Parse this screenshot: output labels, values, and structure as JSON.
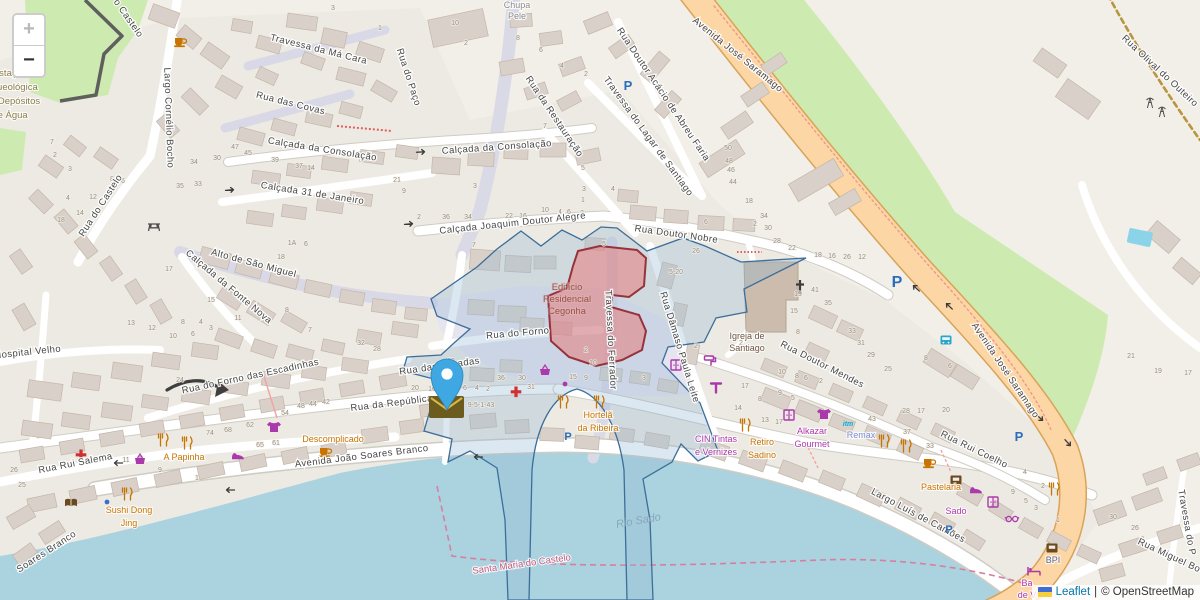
{
  "controls": {
    "zoom_in_label": "+",
    "zoom_out_label": "−"
  },
  "attribution": {
    "leaflet_link": "Leaflet",
    "separator": "|",
    "osm_text": "© OpenStreetMap"
  },
  "colors": {
    "land": "#f2efe8",
    "water": "#aad3df",
    "green": "#cdebb0",
    "road_primary": "#fcd6a4",
    "building": "#d9d0c9",
    "selection_stroke": "#3c6e99",
    "selection_fill": "rgba(147,183,211,0.32)",
    "highlight_fill": "rgba(231,123,123,0.55)",
    "highlight_stroke": "#97323a",
    "marker": "#3fa7e1"
  },
  "street_labels": [
    {
      "t": "Travessa da Má Cara",
      "x": 318,
      "y": 52,
      "r": 14
    },
    {
      "t": "Rua do Paço",
      "x": 406,
      "y": 78,
      "r": 72
    },
    {
      "t": "Rua das Covas",
      "x": 290,
      "y": 106,
      "r": 14
    },
    {
      "t": "Calçada da Consolação",
      "x": 322,
      "y": 152,
      "r": 9
    },
    {
      "t": "Calçada da Consolação",
      "x": 497,
      "y": 150,
      "r": -4
    },
    {
      "t": "Calçada 31 de Janeiro",
      "x": 312,
      "y": 196,
      "r": 9
    },
    {
      "t": "o Castelo",
      "x": 126,
      "y": 20,
      "r": 55
    },
    {
      "t": "Rua do Castelo",
      "x": 103,
      "y": 207,
      "r": -57
    },
    {
      "t": "Largo Cornélio Bocho",
      "x": 166,
      "y": 118,
      "r": 88
    },
    {
      "t": "Alto de São Miguel",
      "x": 253,
      "y": 266,
      "r": 15
    },
    {
      "t": "Calçada da Fonte Nova",
      "x": 227,
      "y": 289,
      "r": 40
    },
    {
      "t": "Calçada Joaquim Doutor Alegre",
      "x": 513,
      "y": 226,
      "r": -6
    },
    {
      "t": "Rua da Restauração",
      "x": 552,
      "y": 118,
      "r": 56
    },
    {
      "t": "Rua Doutor Nobre",
      "x": 676,
      "y": 237,
      "r": 8
    },
    {
      "t": "Travessa do Ferrador",
      "x": 608,
      "y": 340,
      "r": 87
    },
    {
      "t": "Rua Dâmaso Paula Leite",
      "x": 677,
      "y": 348,
      "r": 73
    },
    {
      "t": "Rua do Forno",
      "x": 518,
      "y": 336,
      "r": -5
    },
    {
      "t": "Rua do Forno das Escadinhas",
      "x": 251,
      "y": 379,
      "r": -12
    },
    {
      "t": "Hospital Velho",
      "x": 28,
      "y": 355,
      "r": -6
    },
    {
      "t": "Rua Rui Salema",
      "x": 76,
      "y": 466,
      "r": -11
    },
    {
      "t": "Rua da República",
      "x": 392,
      "y": 406,
      "r": -7
    },
    {
      "t": "Rua das Escadas",
      "x": 440,
      "y": 369,
      "r": -8
    },
    {
      "t": "Avenida João Soares Branco",
      "x": 362,
      "y": 459,
      "r": -7
    },
    {
      "t": "Soares Branco",
      "x": 48,
      "y": 554,
      "r": -33
    },
    {
      "t": "Travessa do Lagar de Santiago",
      "x": 646,
      "y": 138,
      "r": 54
    },
    {
      "t": "Rua Doutor Acácio de Abreu Faria",
      "x": 661,
      "y": 96,
      "r": 56
    },
    {
      "t": "Avenida José Saramago",
      "x": 736,
      "y": 57,
      "r": 39
    },
    {
      "t": "Avenida José Saramago",
      "x": 1003,
      "y": 372,
      "r": 56
    },
    {
      "t": "Rua Olival do Outeiro",
      "x": 1158,
      "y": 73,
      "r": 43
    },
    {
      "t": "Rua Doutor Mendes",
      "x": 821,
      "y": 367,
      "r": 27
    },
    {
      "t": "Rua Rui Coelho",
      "x": 973,
      "y": 452,
      "r": 26
    },
    {
      "t": "Largo Luís de Camões",
      "x": 917,
      "y": 518,
      "r": 28
    },
    {
      "t": "Rua Miguel Bo",
      "x": 1168,
      "y": 558,
      "r": 25
    },
    {
      "t": "Travessa do P",
      "x": 1184,
      "y": 523,
      "r": 80
    }
  ],
  "place_labels": [
    {
      "lines": [
        "Estação",
        "Arqueológica",
        "dos Depósitos",
        "de Água"
      ],
      "x": 10,
      "y": 76,
      "lh": 14,
      "c": "c-site"
    },
    {
      "lines": [
        "Chupa",
        "Pele"
      ],
      "x": 517,
      "y": 8,
      "lh": 11,
      "c": "c-build"
    },
    {
      "lines": [
        "Igreja de",
        "Santiago"
      ],
      "x": 747,
      "y": 339,
      "lh": 12,
      "c": "c-church"
    },
    {
      "lines": [
        "Edifício",
        "Residencial",
        "Cegonha"
      ],
      "x": 567,
      "y": 290,
      "lh": 12,
      "c": "c-redbuild"
    },
    {
      "lines": [
        "Hortelã",
        "da Ribeira"
      ],
      "x": 598,
      "y": 418,
      "lh": 13,
      "c": "c-food"
    },
    {
      "lines": [
        "Sushi Dong",
        "Jing"
      ],
      "x": 129,
      "y": 513,
      "lh": 13,
      "c": "c-food"
    },
    {
      "lines": [
        "CIN Tintas",
        "e Vernizes"
      ],
      "x": 716,
      "y": 442,
      "lh": 13,
      "c": "c-shop"
    },
    {
      "lines": [
        "Retiro",
        "Sadino"
      ],
      "x": 762,
      "y": 445,
      "lh": 13,
      "c": "c-food"
    },
    {
      "lines": [
        "Alkazar",
        "Gourmet"
      ],
      "x": 812,
      "y": 434,
      "lh": 13,
      "c": "c-shop"
    },
    {
      "lines": [
        "Ba",
        "de V"
      ],
      "x": 1027,
      "y": 586,
      "lh": 12,
      "c": "c-shop"
    },
    {
      "t": "Remax",
      "x": 861,
      "y": 438,
      "c": "c-office"
    },
    {
      "t": "BPI",
      "x": 1053,
      "y": 563,
      "c": "c-bank"
    },
    {
      "t": "Descomplicado",
      "x": 333,
      "y": 442,
      "c": "c-food"
    },
    {
      "t": "A Papinha",
      "x": 184,
      "y": 460,
      "c": "c-food"
    },
    {
      "t": "Pastelaria",
      "x": 941,
      "y": 490,
      "c": "c-food"
    },
    {
      "t": "Sado",
      "x": 956,
      "y": 514,
      "c": "c-shop"
    },
    {
      "t": "Rio Sado",
      "x": 639,
      "y": 524,
      "r": -10,
      "c": "c-water"
    },
    {
      "t": "Santa Maria do Castelo",
      "x": 522,
      "y": 567,
      "r": -8,
      "c": "c-boundary"
    },
    {
      "t": "P",
      "x": 628,
      "y": 90,
      "c": "c-parking"
    },
    {
      "t": "P",
      "x": 897,
      "y": 287,
      "c": "c-parking",
      "s": 16
    },
    {
      "t": "P",
      "x": 1019,
      "y": 441,
      "c": "c-parking"
    },
    {
      "t": "P",
      "x": 949,
      "y": 533,
      "c": "c-parking",
      "s": 11
    },
    {
      "t": "P",
      "x": 568,
      "y": 440,
      "c": "c-parking",
      "s": 11
    },
    {
      "t": "itm",
      "x": 848,
      "y": 426,
      "c": "c-agency"
    }
  ],
  "house_numbers": [
    [
      333,
      10,
      "3"
    ],
    [
      380,
      30,
      "1"
    ],
    [
      466,
      45,
      "2"
    ],
    [
      455,
      25,
      "10"
    ],
    [
      518,
      40,
      "8"
    ],
    [
      541,
      52,
      "6"
    ],
    [
      562,
      68,
      "4"
    ],
    [
      586,
      76,
      "2"
    ],
    [
      545,
      128,
      "7"
    ],
    [
      397,
      182,
      "21"
    ],
    [
      404,
      193,
      "9"
    ],
    [
      475,
      188,
      "3"
    ],
    [
      583,
      170,
      "5"
    ],
    [
      584,
      191,
      "3"
    ],
    [
      613,
      191,
      "4"
    ],
    [
      419,
      219,
      "2"
    ],
    [
      446,
      219,
      "36"
    ],
    [
      468,
      219,
      "34"
    ],
    [
      509,
      218,
      "22"
    ],
    [
      523,
      218,
      "16"
    ],
    [
      545,
      212,
      "10"
    ],
    [
      560,
      214,
      "4"
    ],
    [
      569,
      214,
      "6"
    ],
    [
      582,
      215,
      "2"
    ],
    [
      583,
      202,
      "1"
    ],
    [
      474,
      247,
      "7"
    ],
    [
      604,
      246,
      "5"
    ],
    [
      696,
      253,
      "26"
    ],
    [
      676,
      274,
      "5-20"
    ],
    [
      706,
      224,
      "6"
    ],
    [
      755,
      226,
      "2"
    ],
    [
      728,
      150,
      "50"
    ],
    [
      729,
      163,
      "48"
    ],
    [
      731,
      172,
      "46"
    ],
    [
      733,
      184,
      "44"
    ],
    [
      749,
      203,
      "18"
    ],
    [
      764,
      218,
      "34"
    ],
    [
      768,
      230,
      "30"
    ],
    [
      777,
      243,
      "28"
    ],
    [
      792,
      250,
      "22"
    ],
    [
      818,
      257,
      "18"
    ],
    [
      832,
      258,
      "16"
    ],
    [
      847,
      259,
      "26"
    ],
    [
      862,
      259,
      "12"
    ],
    [
      798,
      296,
      "19"
    ],
    [
      815,
      292,
      "41"
    ],
    [
      828,
      305,
      "35"
    ],
    [
      794,
      313,
      "15"
    ],
    [
      798,
      334,
      "8"
    ],
    [
      852,
      333,
      "33"
    ],
    [
      861,
      345,
      "31"
    ],
    [
      871,
      357,
      "29"
    ],
    [
      888,
      371,
      "25"
    ],
    [
      926,
      360,
      "8"
    ],
    [
      950,
      368,
      "6"
    ],
    [
      946,
      412,
      "20"
    ],
    [
      906,
      413,
      "28"
    ],
    [
      921,
      413,
      "17"
    ],
    [
      1131,
      358,
      "21"
    ],
    [
      1158,
      373,
      "19"
    ],
    [
      1188,
      375,
      "17"
    ],
    [
      52,
      144,
      "7"
    ],
    [
      55,
      157,
      "2"
    ],
    [
      70,
      171,
      "3"
    ],
    [
      68,
      200,
      "4"
    ],
    [
      61,
      222,
      "18"
    ],
    [
      80,
      215,
      "14"
    ],
    [
      93,
      199,
      "12"
    ],
    [
      112,
      181,
      "8"
    ],
    [
      123,
      183,
      "6"
    ],
    [
      194,
      164,
      "34"
    ],
    [
      217,
      160,
      "30"
    ],
    [
      180,
      188,
      "35"
    ],
    [
      198,
      186,
      "33"
    ],
    [
      235,
      149,
      "47"
    ],
    [
      248,
      155,
      "45"
    ],
    [
      275,
      162,
      "39"
    ],
    [
      299,
      168,
      "37"
    ],
    [
      311,
      170,
      "14"
    ],
    [
      292,
      245,
      "1A"
    ],
    [
      306,
      246,
      "6"
    ],
    [
      281,
      259,
      "18"
    ],
    [
      169,
      271,
      "17"
    ],
    [
      211,
      302,
      "15"
    ],
    [
      131,
      325,
      "13"
    ],
    [
      152,
      330,
      "12"
    ],
    [
      173,
      338,
      "10"
    ],
    [
      183,
      324,
      "8"
    ],
    [
      193,
      336,
      "6"
    ],
    [
      201,
      324,
      "4"
    ],
    [
      211,
      330,
      "3"
    ],
    [
      238,
      320,
      "11"
    ],
    [
      310,
      332,
      "7"
    ],
    [
      287,
      312,
      "8"
    ],
    [
      180,
      382,
      "24"
    ],
    [
      126,
      462,
      "11"
    ],
    [
      141,
      461,
      "5"
    ],
    [
      160,
      472,
      "9"
    ],
    [
      197,
      480,
      "1"
    ],
    [
      210,
      435,
      "74"
    ],
    [
      228,
      432,
      "68"
    ],
    [
      250,
      427,
      "62"
    ],
    [
      260,
      447,
      "65"
    ],
    [
      276,
      445,
      "61"
    ],
    [
      285,
      415,
      "54"
    ],
    [
      301,
      408,
      "48"
    ],
    [
      313,
      406,
      "44"
    ],
    [
      326,
      404,
      "42"
    ],
    [
      14,
      472,
      "26"
    ],
    [
      22,
      487,
      "25"
    ],
    [
      361,
      345,
      "32"
    ],
    [
      377,
      351,
      "28"
    ],
    [
      451,
      363,
      "12"
    ],
    [
      415,
      390,
      "20"
    ],
    [
      432,
      391,
      "16"
    ],
    [
      465,
      390,
      "6"
    ],
    [
      477,
      390,
      "4"
    ],
    [
      488,
      391,
      "2"
    ],
    [
      481,
      407,
      "9-5-1-43"
    ],
    [
      501,
      380,
      "36"
    ],
    [
      522,
      380,
      "30"
    ],
    [
      531,
      389,
      "31"
    ],
    [
      593,
      365,
      "10"
    ],
    [
      611,
      367,
      "2"
    ],
    [
      573,
      379,
      "15"
    ],
    [
      586,
      380,
      "9"
    ],
    [
      612,
      382,
      "7"
    ],
    [
      644,
      380,
      "3"
    ],
    [
      586,
      352,
      "2"
    ],
    [
      782,
      374,
      "10"
    ],
    [
      797,
      378,
      "8"
    ],
    [
      806,
      380,
      "6"
    ],
    [
      821,
      383,
      "2"
    ],
    [
      745,
      388,
      "17"
    ],
    [
      780,
      395,
      "9"
    ],
    [
      793,
      400,
      "5"
    ],
    [
      760,
      401,
      "8"
    ],
    [
      738,
      410,
      "14"
    ],
    [
      872,
      421,
      "43"
    ],
    [
      907,
      434,
      "37"
    ],
    [
      930,
      448,
      "33"
    ],
    [
      765,
      422,
      "13"
    ],
    [
      779,
      424,
      "17"
    ],
    [
      1025,
      474,
      "4"
    ],
    [
      1043,
      488,
      "2"
    ],
    [
      1013,
      494,
      "9"
    ],
    [
      1026,
      503,
      "5"
    ],
    [
      1036,
      510,
      "3"
    ],
    [
      1058,
      522,
      "1"
    ],
    [
      1113,
      519,
      "30"
    ],
    [
      1135,
      530,
      "26"
    ],
    [
      741,
      345,
      "2"
    ],
    [
      696,
      348,
      "2"
    ]
  ],
  "pois": [
    [
      "cup",
      180,
      42,
      "food"
    ],
    [
      "cup",
      325,
      452,
      "food"
    ],
    [
      "cup",
      929,
      463,
      "food"
    ],
    [
      "fork",
      163,
      440,
      "food"
    ],
    [
      "fork",
      187,
      443,
      "food"
    ],
    [
      "fork",
      127,
      494,
      "food"
    ],
    [
      "fork",
      563,
      402,
      "food"
    ],
    [
      "fork",
      599,
      402,
      "food"
    ],
    [
      "fork",
      745,
      425,
      "food"
    ],
    [
      "fork",
      884,
      441,
      "food"
    ],
    [
      "fork",
      906,
      446,
      "food"
    ],
    [
      "fork",
      1054,
      489,
      "food"
    ],
    [
      "tshirt",
      274,
      427,
      "shop"
    ],
    [
      "tshirt",
      824,
      414,
      "shop"
    ],
    [
      "basket",
      140,
      459,
      "shop"
    ],
    [
      "basket",
      545,
      370,
      "shop"
    ],
    [
      "shoe",
      238,
      455,
      "shop"
    ],
    [
      "shoe",
      976,
      489,
      "shop"
    ],
    [
      "wardrobe",
      676,
      365,
      "shop"
    ],
    [
      "wardrobe",
      993,
      502,
      "shop"
    ],
    [
      "wardrobe",
      789,
      415,
      "shop"
    ],
    [
      "dot",
      565,
      384,
      "shop"
    ],
    [
      "dot",
      107,
      502,
      "blue"
    ],
    [
      "roller",
      710,
      361,
      "shop"
    ],
    [
      "tap",
      716,
      387,
      "shop"
    ],
    [
      "glasses",
      1012,
      519,
      "shop"
    ],
    [
      "bed",
      1034,
      571,
      "shop"
    ],
    [
      "cross",
      516,
      392,
      "health"
    ],
    [
      "cross",
      81,
      455,
      "health"
    ],
    [
      "book",
      71,
      503,
      "brown"
    ],
    [
      "atm",
      956,
      480,
      "brown"
    ],
    [
      "atm",
      1052,
      548,
      "brown"
    ],
    [
      "picnic",
      154,
      226,
      "dark"
    ],
    [
      "mast",
      1150,
      103,
      "dark"
    ],
    [
      "mast",
      1162,
      112,
      "dark"
    ],
    [
      "bus",
      946,
      340,
      "transit"
    ]
  ],
  "oneway_arrows": [
    [
      118,
      463,
      180
    ],
    [
      230,
      490,
      180
    ],
    [
      409,
      224,
      -5
    ],
    [
      230,
      190,
      -5
    ],
    [
      421,
      152,
      -3
    ],
    [
      478,
      457,
      180
    ],
    [
      916,
      288,
      223
    ],
    [
      949,
      306,
      223
    ],
    [
      1040,
      418,
      43
    ],
    [
      1068,
      443,
      48
    ]
  ]
}
